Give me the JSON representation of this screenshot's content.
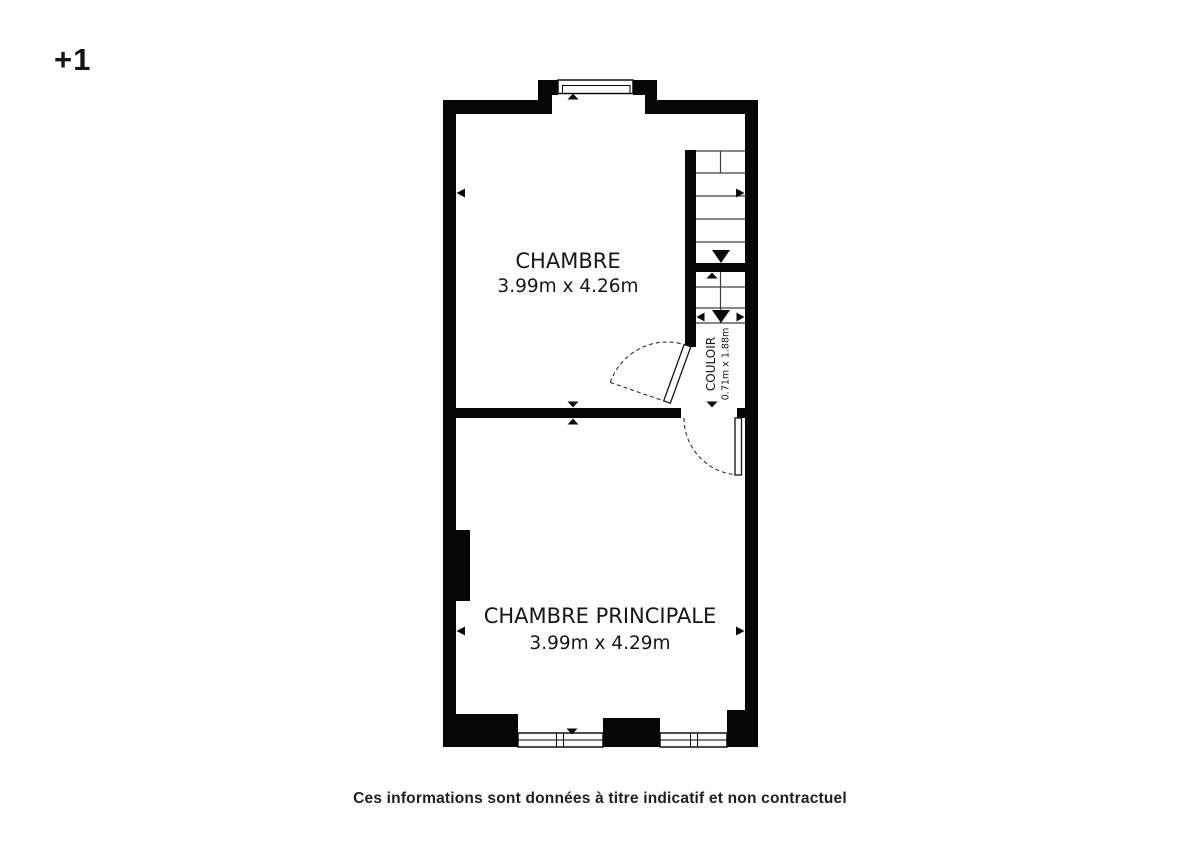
{
  "floor_indicator": "+1",
  "plan": {
    "rooms": [
      {
        "name": "CHAMBRE",
        "dimensions": "3.99m x 4.26m"
      },
      {
        "name": "CHAMBRE PRINCIPALE",
        "dimensions": "3.99m x 4.29m"
      },
      {
        "name": "COULOIR",
        "dimensions": "0.71m x 1.88m"
      }
    ],
    "colors": {
      "wall": "#060606",
      "background": "#ffffff",
      "label": "#161616",
      "stair_tread": "#3f3f3f",
      "door_swing": "#2e2e2e"
    }
  },
  "footer": {
    "disclaimer": "Ces informations sont données à titre indicatif et non contractuel"
  }
}
